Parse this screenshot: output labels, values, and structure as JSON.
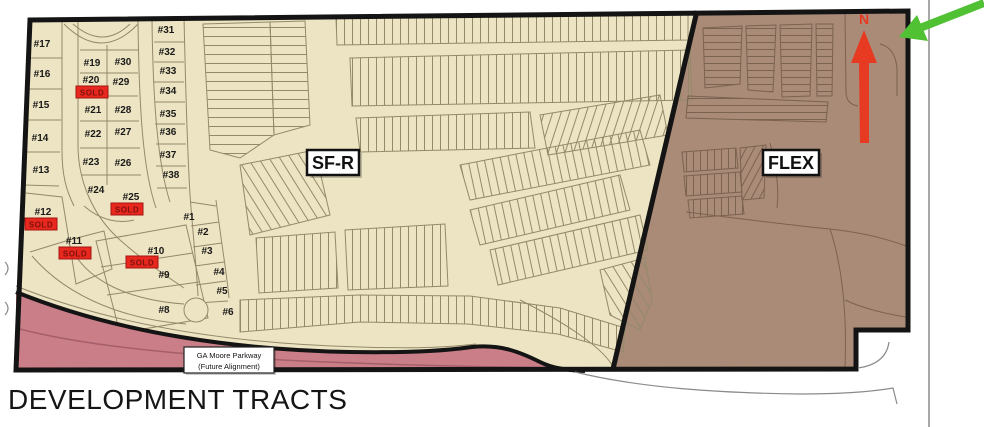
{
  "title": "DEVELOPMENT TRACTS",
  "zones": {
    "sfr_label": "SF-R",
    "flex_label": "FLEX"
  },
  "road_label": {
    "line1": "GA Moore Parkway",
    "line2": "(Future Alignment)"
  },
  "north_label": "N",
  "sold_label": "SOLD",
  "colors": {
    "sfr_fill": "#ece4c2",
    "flex_fill": "#a98b77",
    "road_fill": "#ca7e88",
    "road_centerline": "#a55f6a",
    "outline_black": "#141414",
    "parcel_line": "#948a6a",
    "flex_line": "#7c6251",
    "sold_red": "#e8281e",
    "north_arrow_red": "#e73a22",
    "pointer_green": "#4fc133"
  },
  "lots": [
    {
      "label": "#17",
      "x": 42,
      "y": 47
    },
    {
      "label": "#16",
      "x": 42,
      "y": 77
    },
    {
      "label": "#15",
      "x": 41,
      "y": 108
    },
    {
      "label": "#14",
      "x": 40,
      "y": 141
    },
    {
      "label": "#13",
      "x": 41,
      "y": 173
    },
    {
      "label": "#12",
      "x": 43,
      "y": 215,
      "sold": {
        "x": 41,
        "y": 224
      }
    },
    {
      "label": "#11",
      "x": 74,
      "y": 244,
      "sold": {
        "x": 75,
        "y": 253
      }
    },
    {
      "label": "#19",
      "x": 92,
      "y": 66
    },
    {
      "label": "#20",
      "x": 91,
      "y": 83,
      "sold": {
        "x": 92,
        "y": 92
      }
    },
    {
      "label": "#21",
      "x": 93,
      "y": 113
    },
    {
      "label": "#22",
      "x": 93,
      "y": 137
    },
    {
      "label": "#23",
      "x": 91,
      "y": 165
    },
    {
      "label": "#24",
      "x": 96,
      "y": 193
    },
    {
      "label": "#30",
      "x": 123,
      "y": 65
    },
    {
      "label": "#29",
      "x": 121,
      "y": 85
    },
    {
      "label": "#28",
      "x": 123,
      "y": 113
    },
    {
      "label": "#27",
      "x": 123,
      "y": 135
    },
    {
      "label": "#26",
      "x": 123,
      "y": 166
    },
    {
      "label": "#25",
      "x": 131,
      "y": 200,
      "sold": {
        "x": 127,
        "y": 209
      }
    },
    {
      "label": "#31",
      "x": 166,
      "y": 33
    },
    {
      "label": "#32",
      "x": 167,
      "y": 55
    },
    {
      "label": "#33",
      "x": 168,
      "y": 74
    },
    {
      "label": "#34",
      "x": 168,
      "y": 94
    },
    {
      "label": "#35",
      "x": 168,
      "y": 117
    },
    {
      "label": "#36",
      "x": 168,
      "y": 135
    },
    {
      "label": "#37",
      "x": 168,
      "y": 158
    },
    {
      "label": "#38",
      "x": 171,
      "y": 178
    },
    {
      "label": "#1",
      "x": 189,
      "y": 220
    },
    {
      "label": "#2",
      "x": 203,
      "y": 235
    },
    {
      "label": "#3",
      "x": 207,
      "y": 254
    },
    {
      "label": "#4",
      "x": 219,
      "y": 275
    },
    {
      "label": "#5",
      "x": 222,
      "y": 294
    },
    {
      "label": "#6",
      "x": 228,
      "y": 315
    },
    {
      "label": "#8",
      "x": 164,
      "y": 313
    },
    {
      "label": "#9",
      "x": 164,
      "y": 278
    },
    {
      "label": "#10",
      "x": 156,
      "y": 254,
      "sold": {
        "x": 142,
        "y": 262
      }
    }
  ]
}
